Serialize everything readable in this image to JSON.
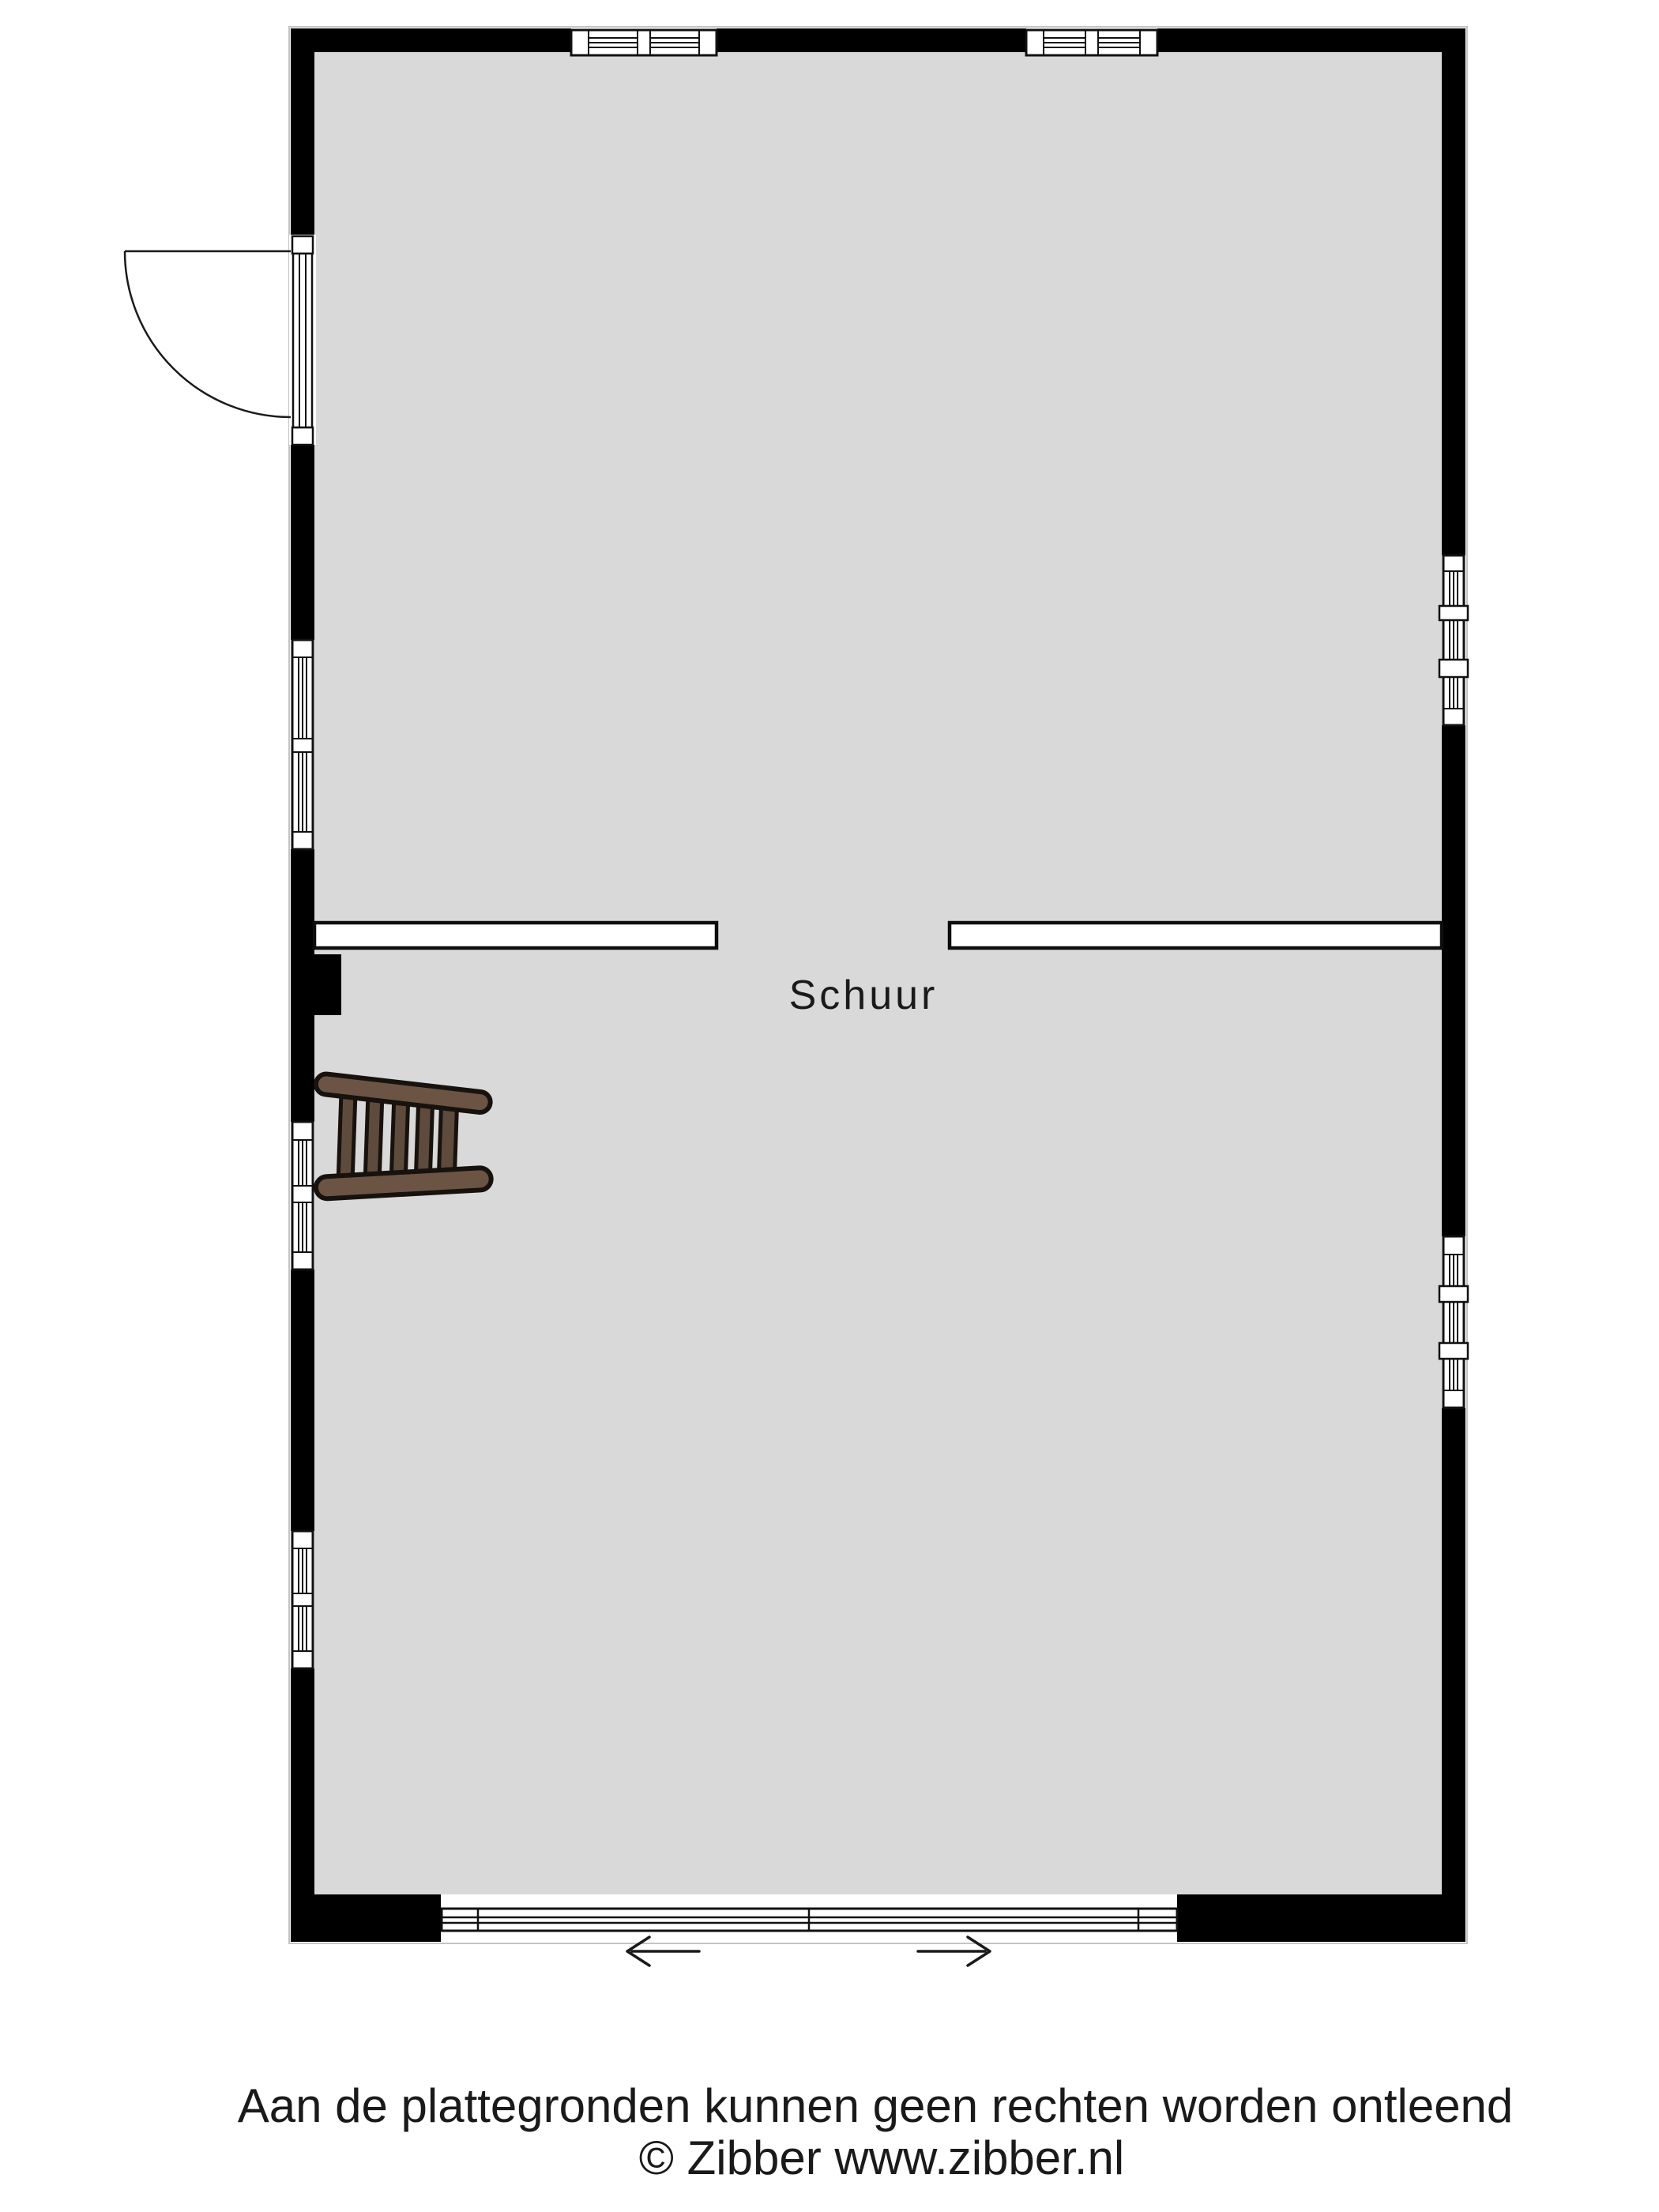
{
  "plan": {
    "room_label": "Schuur"
  },
  "footer": {
    "disclaimer": "Aan de plattegronden kunnen geen rechten worden ontleend",
    "copyright": "© Zibber www.zibber.nl"
  },
  "colors": {
    "background": "#ffffff",
    "floor": "#d9d9d9",
    "wall": "#000000",
    "line": "#1a1a1a",
    "ladder_rail": "#6b5444",
    "ladder_rung": "#5f4b3b"
  },
  "icons": {
    "ladder": "wooden-ladder",
    "entry_door": "hinged-door-swing-arc",
    "sliding_door": "sliding-door-tracks",
    "slide_left": "arrow-left",
    "slide_right": "arrow-right"
  }
}
